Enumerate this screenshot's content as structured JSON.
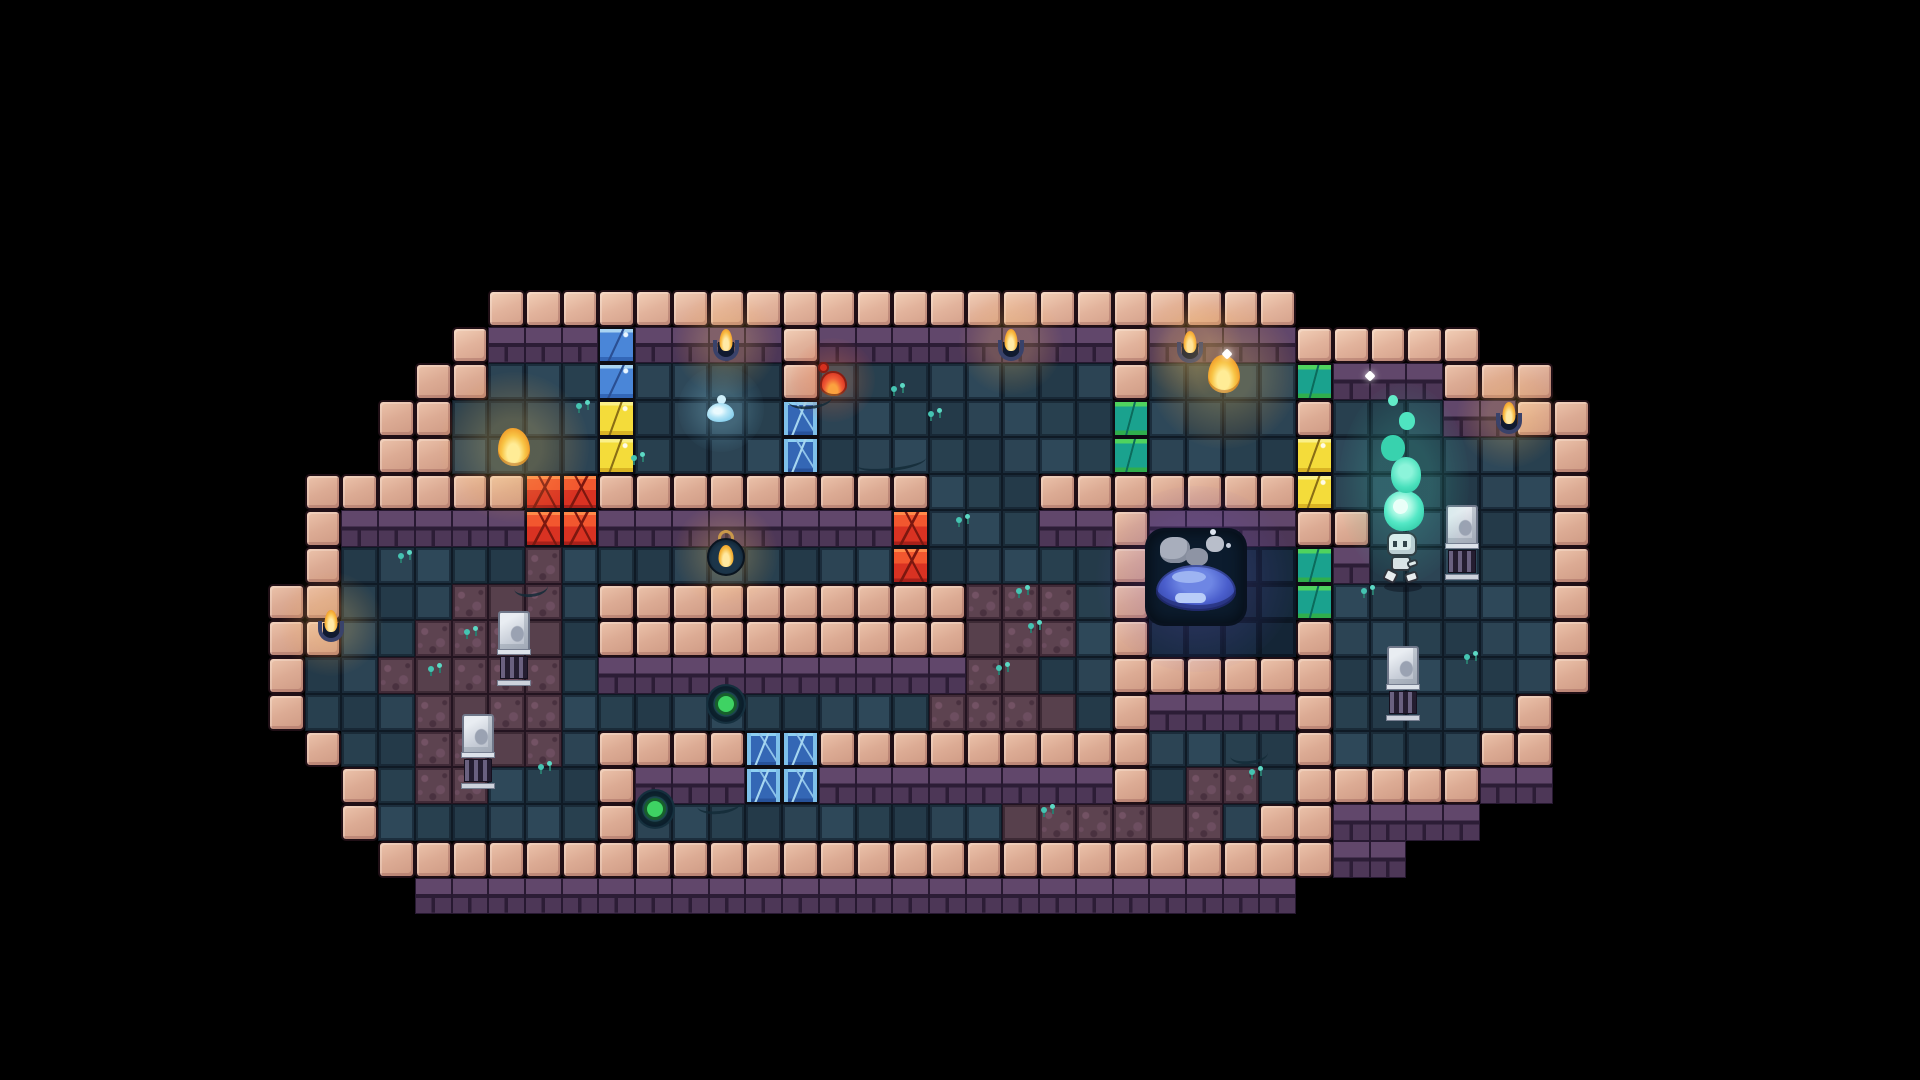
{
  "scene": {
    "type": "pixel-art-dungeon-level",
    "background_color": "#000000"
  },
  "palette": {
    "wall_brick": "#dcab94",
    "wall_brick_light": "#ecc3ab",
    "wall_face_purple": "#533c5b",
    "floor_teal": "#2c4454",
    "alcove_navy": "#16293c",
    "moss_mauve": "#5d4350",
    "door_blue": "#4a86d8",
    "door_yellow": "#f4dc3a",
    "door_green_cap": "#4fd35f",
    "door_green_body": "#1aa28e",
    "door_red": "#d93222",
    "door_ice": "#3467b5",
    "torch_flame": "#f9bd45",
    "slime_blue": "#4a5ecc",
    "soul_flame_teal": "#54e8c6",
    "button_green": "#3ed363",
    "sprout_teal": "#45c4b2"
  },
  "map": {
    "origin_x": 268,
    "origin_y": 290,
    "tile_size": 36.72,
    "cols": 36,
    "rows_count": 17,
    "legend": {
      "W": {
        "name": "wall-brick-tile",
        "interactable": false
      },
      "S": {
        "name": "wall-face-tile",
        "interactable": false
      },
      "f": {
        "name": "floor-tile",
        "interactable": false
      },
      "d": {
        "name": "alcove-floor-tile",
        "interactable": false
      },
      "m": {
        "name": "moss-floor-tile",
        "interactable": false
      },
      "B": {
        "name": "door-blue-tile",
        "interactable": true
      },
      "Y": {
        "name": "door-yellow-tile",
        "interactable": true
      },
      "G": {
        "name": "door-green-tile",
        "interactable": true
      },
      "R": {
        "name": "door-red-tile",
        "interactable": true
      },
      "I": {
        "name": "door-ice-tile",
        "interactable": true
      }
    },
    "rows": [
      "......WWWWWWWWWWWWWWWWWWWWWW........",
      ".....WSSSBSSSSWSSSSSSSSWSSSSWWWWW...",
      "....WWfffBffffWffffffffWffffGSSSWWW.",
      "...WWffffYffffIffffffffGffffWfffSSWW",
      "...WWffffYffffIffffffffGffffYffffffW",
      ".WWWWWWRRWWWWWWWWWfffWWWWWWWYffffffW",
      ".WSSSSSRRSSSSSSSSRfffSSWSSSSWWfffffW",
      ".WfffffmfffffffffRfffffWddddGSfffffW",
      "WWfffmmmfWWWWWWWWWWmmmfWddddGffffffW",
      "WWffmmmmfWWWWWWWWWWmmmfWddddWffffffW",
      "WffmmmmmfSSSSSSSSSSmmffWWWWWWffffffW",
      "WfffmmmmffffffffffmmmmfWSSSSWfffffW.",
      ".WffmmmmfWWWWIIWWWWWWWWWffffWffffWW.",
      "..WfmmfffWSSSIISSSSSSSSWfmmfWWWWWSS.",
      "..WffffffWffffffffffmmmmmmfWWSSSS...",
      "...WWWWWWWWWWWWWWWWWWWWWWWWWWSS.....",
      "....SSSSSSSSSSSSSSSSSSSSSSSS........"
    ]
  },
  "entity_defaults": {
    "torch": {
      "w": 28,
      "h": 40
    },
    "flame-item": {
      "w": 36,
      "h": 42
    },
    "lantern": {
      "w": 40,
      "h": 48
    },
    "potion": {
      "w": 32,
      "h": 36
    },
    "droplet": {
      "w": 28,
      "h": 28
    },
    "orb-button": {
      "w": 40,
      "h": 40
    },
    "grate": {
      "w": 34,
      "h": 76
    },
    "slime-pool": {
      "w": 100,
      "h": 100
    },
    "character": {
      "w": 52,
      "h": 64
    },
    "flame-teal": {
      "w": 56,
      "h": 142
    },
    "sparkle": {
      "w": 8,
      "h": 8
    },
    "sprout": {
      "w": 16,
      "h": 13
    },
    "vine": {
      "w": 44,
      "h": 16
    }
  },
  "entities": [
    {
      "kind": "torch",
      "name": "wall-torch",
      "x": 712,
      "y": 329,
      "interactable": false
    },
    {
      "kind": "torch",
      "name": "wall-torch",
      "x": 997,
      "y": 329,
      "interactable": false
    },
    {
      "kind": "torch",
      "name": "wall-torch",
      "x": 1176,
      "y": 331,
      "interactable": false
    },
    {
      "kind": "torch",
      "name": "wall-torch",
      "x": 1495,
      "y": 402,
      "interactable": false
    },
    {
      "kind": "torch",
      "name": "wall-torch",
      "x": 317,
      "y": 610,
      "interactable": false
    },
    {
      "kind": "flame-item",
      "name": "gold-flame-pickup",
      "x": 1206,
      "y": 353,
      "interactable": true
    },
    {
      "kind": "flame-item",
      "name": "gold-flame-pickup",
      "x": 496,
      "y": 426,
      "interactable": true
    },
    {
      "kind": "lantern",
      "name": "lantern-pickup",
      "x": 706,
      "y": 530,
      "interactable": true
    },
    {
      "kind": "potion",
      "name": "red-potion-pickup",
      "x": 817,
      "y": 362,
      "interactable": true
    },
    {
      "kind": "droplet",
      "name": "water-droplet-pickup",
      "x": 707,
      "y": 395,
      "interactable": true
    },
    {
      "kind": "orb-button",
      "name": "floor-button",
      "x": 706,
      "y": 684,
      "interactable": true
    },
    {
      "kind": "orb-button",
      "name": "floor-button",
      "x": 635,
      "y": 789,
      "interactable": true
    },
    {
      "kind": "grate",
      "name": "wall-grate",
      "x": 1445,
      "y": 505,
      "interactable": false
    },
    {
      "kind": "grate",
      "name": "wall-grate",
      "x": 1386,
      "y": 646,
      "interactable": false
    },
    {
      "kind": "grate",
      "name": "wall-grate",
      "x": 497,
      "y": 611,
      "interactable": false
    },
    {
      "kind": "grate",
      "name": "wall-grate",
      "x": 461,
      "y": 714,
      "interactable": false
    },
    {
      "kind": "slime-pool",
      "name": "slime-pool",
      "x": 1146,
      "y": 529,
      "interactable": true
    },
    {
      "kind": "character",
      "name": "player-character",
      "x": 1377,
      "y": 530,
      "interactable": true
    },
    {
      "kind": "flame-teal",
      "name": "soul-flame",
      "x": 1376,
      "y": 395,
      "interactable": false
    },
    {
      "kind": "sparkle",
      "name": "sparkle",
      "x": 1366,
      "y": 372,
      "interactable": false
    },
    {
      "kind": "sparkle",
      "name": "sparkle",
      "x": 1223,
      "y": 350,
      "interactable": false
    },
    {
      "kind": "sprout",
      "name": "moss-sprout",
      "x": 575,
      "y": 400,
      "interactable": false
    },
    {
      "kind": "sprout",
      "name": "moss-sprout",
      "x": 630,
      "y": 452,
      "interactable": false
    },
    {
      "kind": "sprout",
      "name": "moss-sprout",
      "x": 890,
      "y": 383,
      "interactable": false
    },
    {
      "kind": "sprout",
      "name": "moss-sprout",
      "x": 927,
      "y": 408,
      "interactable": false
    },
    {
      "kind": "sprout",
      "name": "moss-sprout",
      "x": 397,
      "y": 550,
      "interactable": false
    },
    {
      "kind": "sprout",
      "name": "moss-sprout",
      "x": 463,
      "y": 626,
      "interactable": false
    },
    {
      "kind": "sprout",
      "name": "moss-sprout",
      "x": 427,
      "y": 663,
      "interactable": false
    },
    {
      "kind": "sprout",
      "name": "moss-sprout",
      "x": 537,
      "y": 761,
      "interactable": false
    },
    {
      "kind": "sprout",
      "name": "moss-sprout",
      "x": 955,
      "y": 514,
      "interactable": false
    },
    {
      "kind": "sprout",
      "name": "moss-sprout",
      "x": 1015,
      "y": 585,
      "interactable": false
    },
    {
      "kind": "sprout",
      "name": "moss-sprout",
      "x": 1027,
      "y": 620,
      "interactable": false
    },
    {
      "kind": "sprout",
      "name": "moss-sprout",
      "x": 995,
      "y": 662,
      "interactable": false
    },
    {
      "kind": "sprout",
      "name": "moss-sprout",
      "x": 1040,
      "y": 804,
      "interactable": false
    },
    {
      "kind": "sprout",
      "name": "moss-sprout",
      "x": 1248,
      "y": 766,
      "interactable": false
    },
    {
      "kind": "sprout",
      "name": "moss-sprout",
      "x": 1463,
      "y": 651,
      "interactable": false
    },
    {
      "kind": "sprout",
      "name": "moss-sprout",
      "x": 1360,
      "y": 585,
      "interactable": false
    },
    {
      "kind": "vine",
      "name": "vine-decor",
      "x": 788,
      "y": 390,
      "interactable": false
    },
    {
      "kind": "vine",
      "name": "vine-decor",
      "x": 856,
      "y": 452,
      "w": 70,
      "interactable": false
    },
    {
      "kind": "vine",
      "name": "vine-decor",
      "x": 697,
      "y": 795,
      "interactable": false
    },
    {
      "kind": "vine",
      "name": "vine-decor",
      "x": 1230,
      "y": 745,
      "w": 38,
      "interactable": false
    },
    {
      "kind": "vine",
      "name": "vine-decor",
      "x": 514,
      "y": 578,
      "w": 34,
      "interactable": false
    }
  ]
}
